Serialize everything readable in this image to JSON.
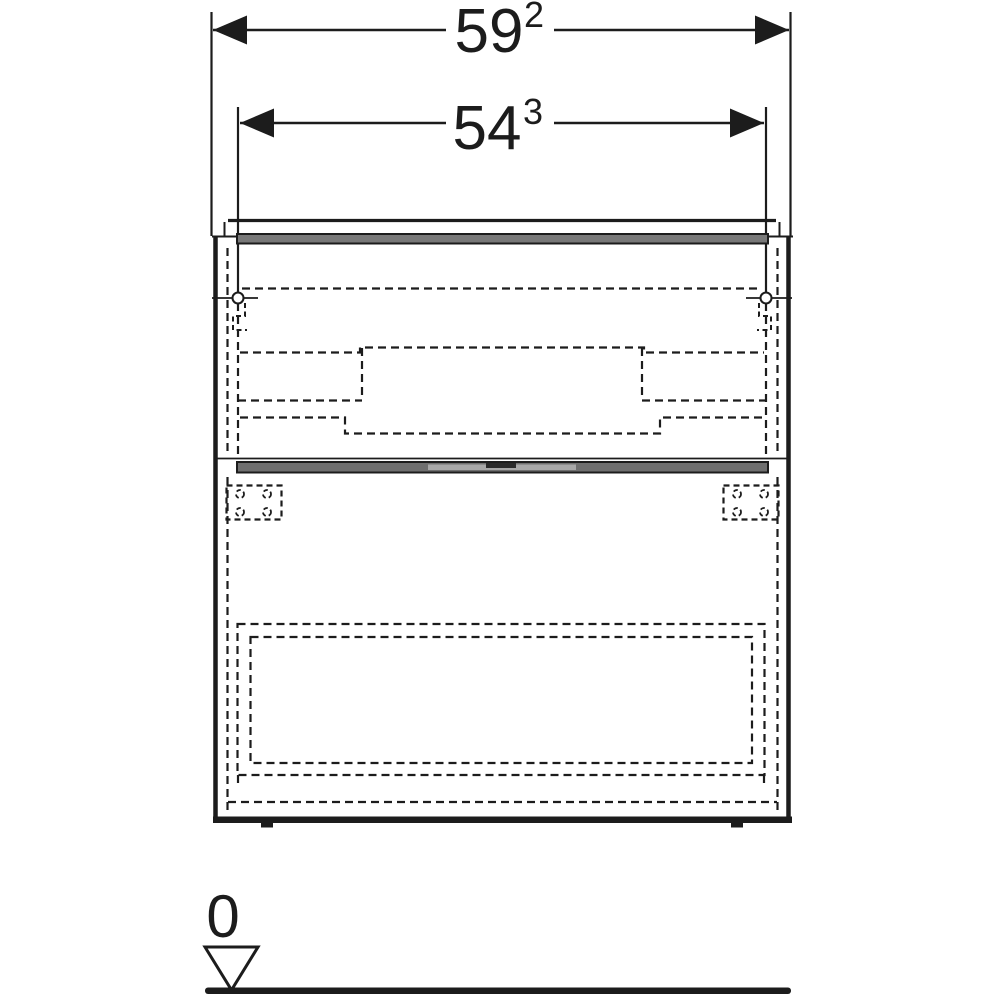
{
  "dimensions": {
    "overall_width": {
      "main": "59",
      "sup": "2"
    },
    "drilling_width": {
      "main": "54",
      "sup": "3"
    },
    "floor_level": {
      "main": "0"
    }
  },
  "colors": {
    "line": "#1c1c1c",
    "panel_gray": "#787878",
    "panel_light_gray": "#a8a8a8",
    "panel_dark_notch": "#2a2a2a",
    "background": "#ffffff"
  }
}
